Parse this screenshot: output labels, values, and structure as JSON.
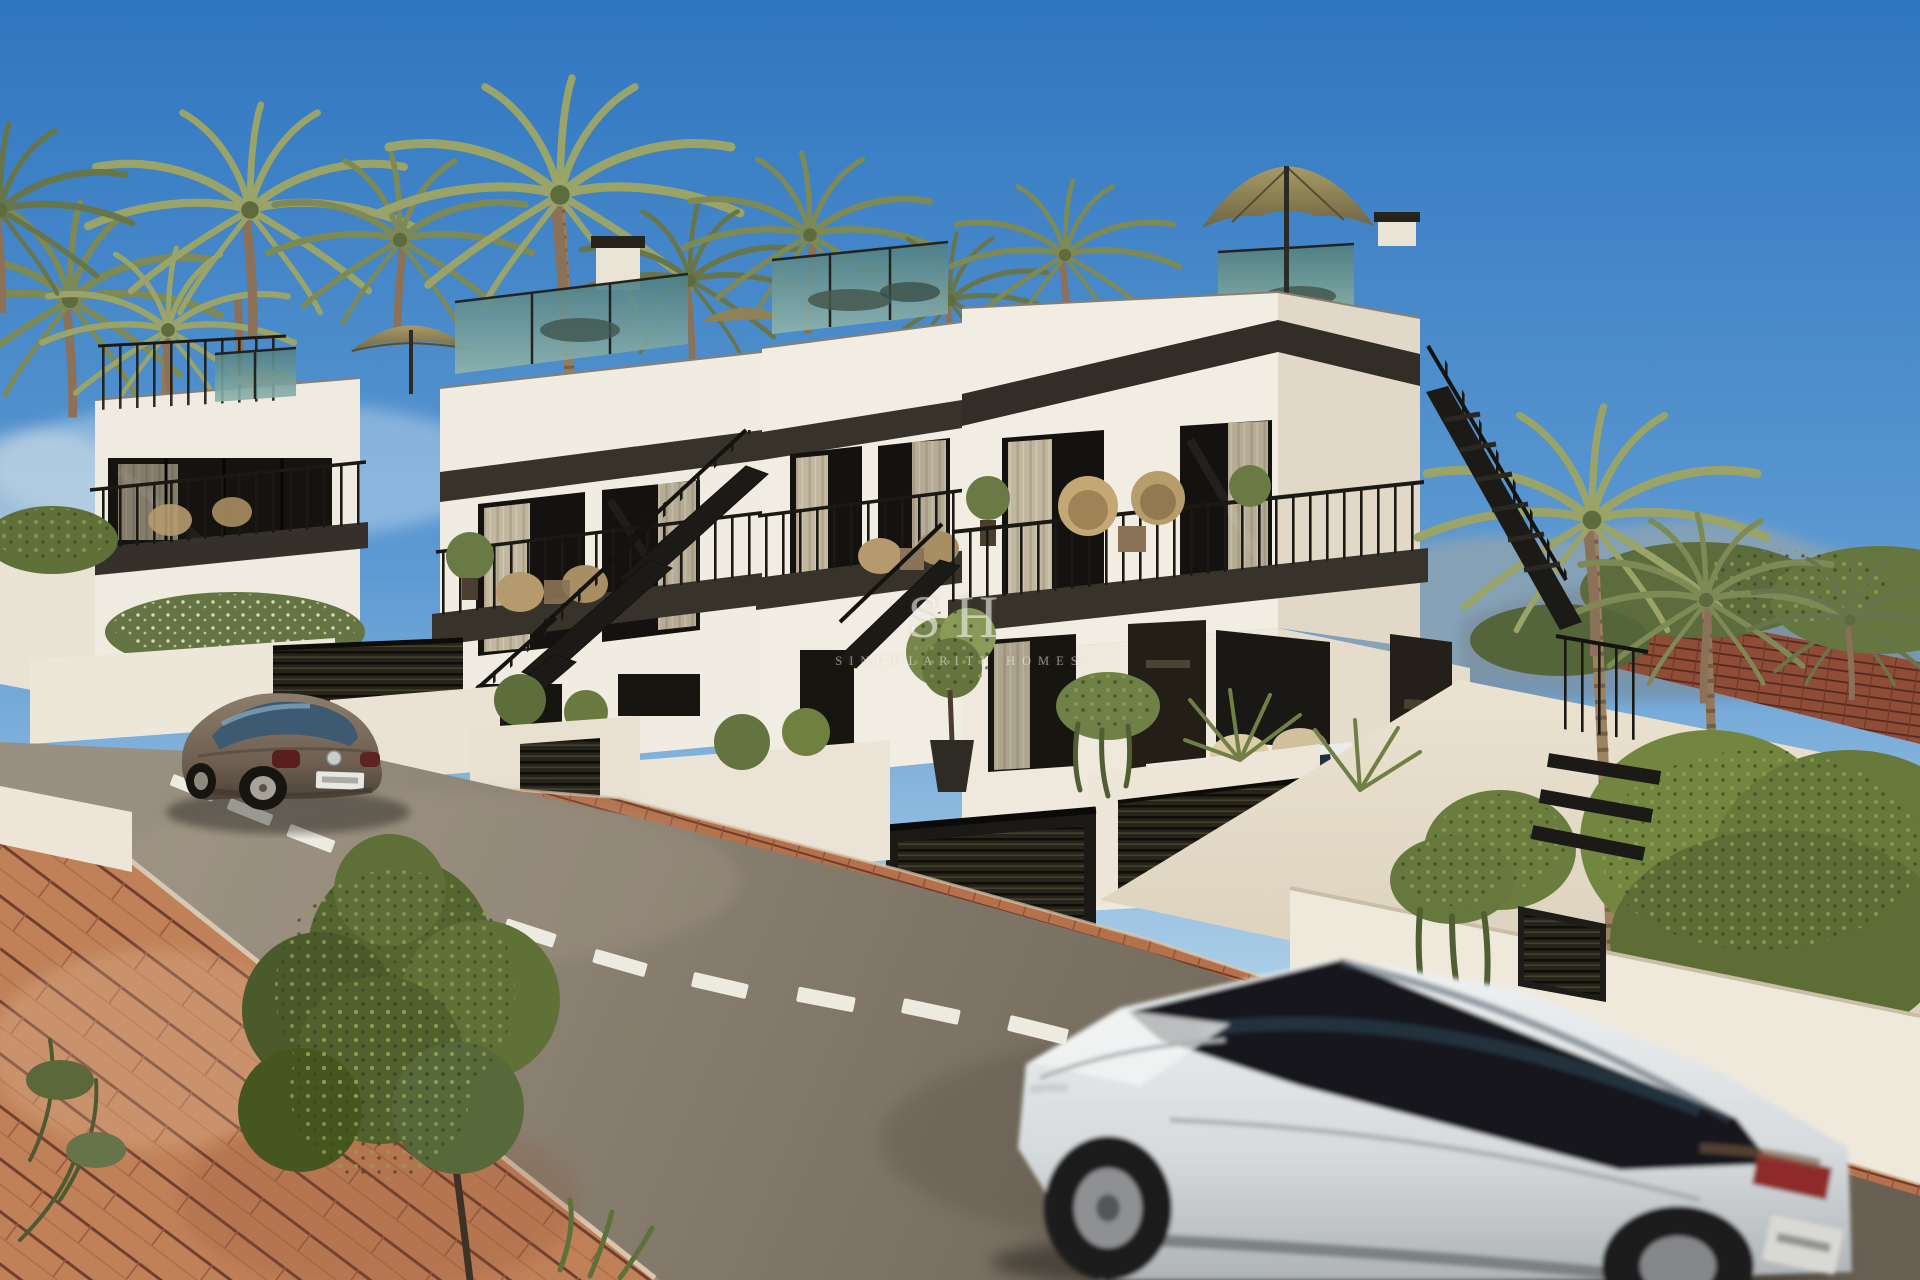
{
  "image": {
    "type": "architectural-render",
    "subject": "Street view of a row of modern white new-build townhouses with roof terraces, black metal staircases, palm trees, a parked beetle car and a white SUV driving past",
    "width_px": 1920,
    "height_px": 1280
  },
  "watermark": {
    "logo": "SH",
    "brand": "SINGULARITY HOMES",
    "color": "#FFFFFF"
  },
  "palette": {
    "sky_top": "#2F76C0",
    "sky_horizon": "#D9E9F4",
    "wall_sunlit": "#F1ECE1",
    "wall_shaded": "#DFD5C4",
    "dark_trim": "#2E2B24",
    "roof_glass_teal": "#5F8C8E",
    "umbrella_khaki": "#95885C",
    "hedge_green": "#6B7D42",
    "palm_olive": "#7E8A55",
    "road_asphalt": "#82786B",
    "pavement_brick": "#BE7E57",
    "retaining_brick": "#8F4D38",
    "suv_body": "#E4E7E9",
    "suv_glass": "#17191C",
    "beetle_body": "#6E5F51",
    "tail_light_red": "#8E2B2C"
  },
  "scene": {
    "objects": [
      "sky",
      "distant-hills",
      "palm-trees",
      "townhouse-row",
      "roof-terraces",
      "glass-balustrades",
      "sun-umbrellas",
      "balconies",
      "exterior-staircases",
      "garage-doors",
      "planter-hedges",
      "right-hedges",
      "boundary-wall",
      "brick-sidewalk",
      "asphalt-road",
      "lane-dashes",
      "brick-pavement",
      "street-tree",
      "parked-beetle-car",
      "courtyard-car",
      "white-suv",
      "watermark"
    ]
  }
}
